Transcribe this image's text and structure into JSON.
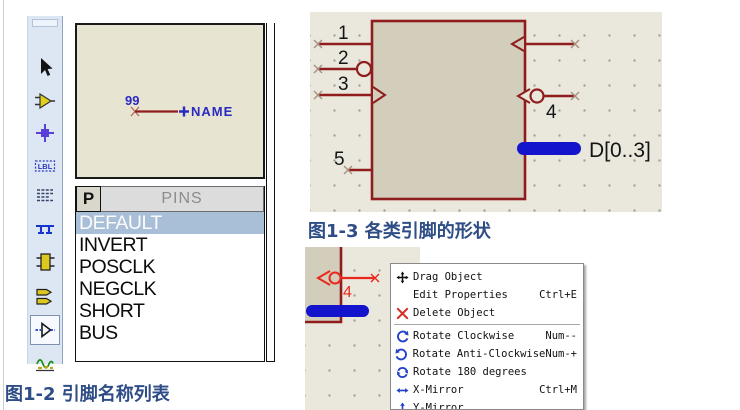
{
  "colors": {
    "pin_red": "#8f1d1d",
    "selected_pin_red": "#e8281e",
    "bus_blue": "#1414cc",
    "caption_blue": "#2e4d86",
    "list_selection_bg": "#a9bfd8",
    "toolbar_bg": "#dde6f3",
    "canvas_bg": "#eae8dd",
    "component_fill": "#d2cebb"
  },
  "toolbar": {
    "tools": [
      "selection-pointer",
      "component-mode",
      "junction-dot-mode",
      "wire-label-mode",
      "text-script-mode",
      "buses-mode",
      "subcircuit-mode",
      "terminals-mode",
      "device-pins-mode",
      "graph-mode"
    ],
    "selected_tool": "device-pins-mode"
  },
  "preview": {
    "pin_number": "99",
    "pin_name": "NAME"
  },
  "pins_panel": {
    "button_label": "P",
    "header": "PINS",
    "items": [
      "DEFAULT",
      "INVERT",
      "POSCLK",
      "NEGCLK",
      "SHORT",
      "BUS"
    ],
    "selected_item": "DEFAULT"
  },
  "captions": {
    "fig_1_2": "图1-2  引脚名称列表",
    "fig_1_3": "图1-3  各类引脚的形状"
  },
  "schematic": {
    "pin_labels": [
      "1",
      "2",
      "3",
      "4",
      "5"
    ],
    "bus_label": "D[0..3]"
  },
  "mini_schematic": {
    "pin_label": "4"
  },
  "context_menu": {
    "items": [
      {
        "icon": "move-icon",
        "label": "Drag Object",
        "shortcut": ""
      },
      {
        "icon": "",
        "label": "Edit Properties",
        "shortcut": "Ctrl+E"
      },
      {
        "icon": "delete-icon",
        "label": "Delete Object",
        "shortcut": ""
      },
      {
        "icon": "rotate-clockwise-icon",
        "label": "Rotate Clockwise",
        "shortcut": "Num--"
      },
      {
        "icon": "rotate-anticlockwise-icon",
        "label": "Rotate Anti-Clockwise",
        "shortcut": "Num-+"
      },
      {
        "icon": "rotate-180-icon",
        "label": "Rotate 180 degrees",
        "shortcut": ""
      },
      {
        "icon": "x-mirror-icon",
        "label": "X-Mirror",
        "shortcut": "Ctrl+M"
      },
      {
        "icon": "y-mirror-icon",
        "label": "Y-Mirror",
        "shortcut": ""
      }
    ]
  }
}
